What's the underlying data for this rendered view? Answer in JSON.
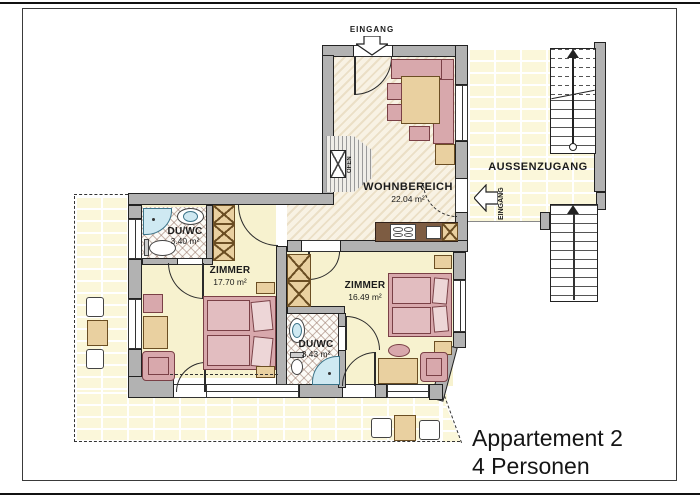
{
  "title": {
    "line1": "Appartement 2",
    "line2": "4 Personen"
  },
  "rooms": {
    "living": {
      "name": "WOHNBEREICH",
      "area": "22.04 m²"
    },
    "bedroom1": {
      "name": "ZIMMER",
      "area": "17.70 m²"
    },
    "bedroom2": {
      "name": "ZIMMER",
      "area": "16.49 m²"
    },
    "bath1": {
      "name": "DU/WC",
      "area": "3.40 m²"
    },
    "bath2": {
      "name": "DU/WC",
      "area": "3.43 m²"
    }
  },
  "labels": {
    "entrance_top": "EINGANG",
    "entrance_side": "EINGANG",
    "outside_access": "AUSSENZUGANG",
    "stove": "OFEN"
  },
  "colors": {
    "wall": "#b2b2b2",
    "room_floor": "#f7f2cf",
    "living_hatch": "#ebdfc6",
    "terrace_brick": "#fbf7da",
    "furniture_pink": "#d8a8ac",
    "furniture_wood": "#e9d0a0",
    "fixture_blue": "#cfe9f2",
    "counter_brown": "#7d5c42"
  }
}
